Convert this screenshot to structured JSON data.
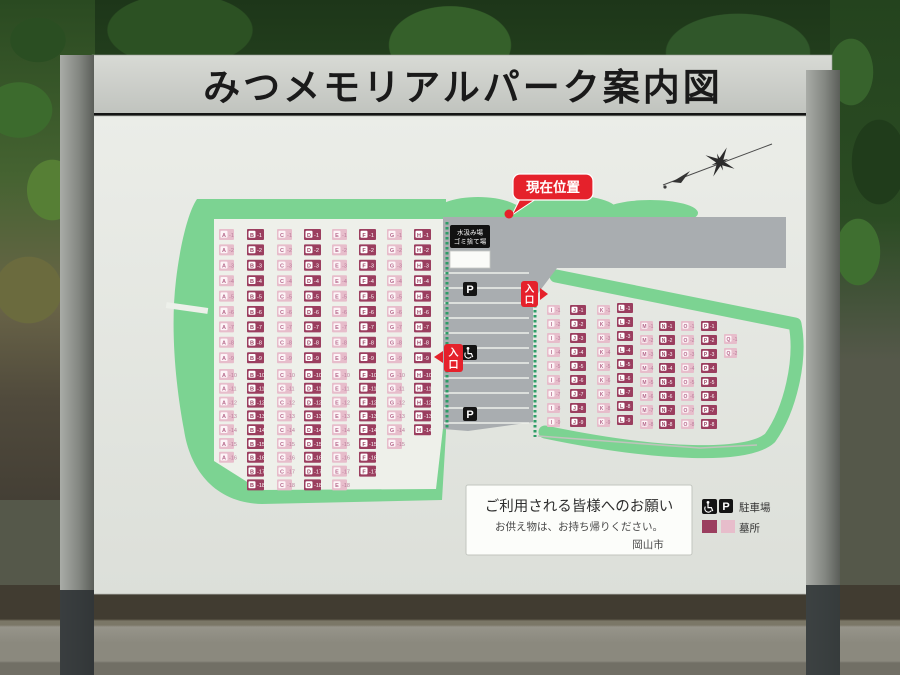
{
  "sign": {
    "title": "みつメモリアルパーク案内図"
  },
  "map": {
    "current_location": {
      "label": "現在位置"
    },
    "entrances": {
      "label": "入口",
      "char1": "入",
      "char2": "口"
    },
    "facility": {
      "line1": "水汲み場",
      "line2": "ゴミ捨て場"
    },
    "icons": {
      "parking": "P"
    },
    "plots": {
      "blocks": [
        {
          "name": "west",
          "cell": {
            "h": 11,
            "dark_w": 17,
            "pink_w": 15,
            "font": 5.5
          },
          "cols": [
            {
              "letter": "A",
              "shade": "pink",
              "x": 219,
              "segments": [
                {
                  "y": 229,
                  "pitch": 15.4,
                  "from": 1,
                  "to": 9
                },
                {
                  "y": 369,
                  "pitch": 13.8,
                  "from": 10,
                  "to": 16
                }
              ]
            },
            {
              "letter": "B",
              "shade": "dark",
              "x": 247,
              "segments": [
                {
                  "y": 229,
                  "pitch": 15.4,
                  "from": 1,
                  "to": 9
                },
                {
                  "y": 369,
                  "pitch": 13.8,
                  "from": 10,
                  "to": 18
                }
              ]
            },
            {
              "letter": "C",
              "shade": "pink",
              "x": 277,
              "segments": [
                {
                  "y": 229,
                  "pitch": 15.4,
                  "from": 1,
                  "to": 9
                },
                {
                  "y": 369,
                  "pitch": 13.8,
                  "from": 10,
                  "to": 18
                }
              ]
            },
            {
              "letter": "D",
              "shade": "dark",
              "x": 304,
              "segments": [
                {
                  "y": 229,
                  "pitch": 15.4,
                  "from": 1,
                  "to": 9
                },
                {
                  "y": 369,
                  "pitch": 13.8,
                  "from": 10,
                  "to": 18
                }
              ]
            },
            {
              "letter": "E",
              "shade": "pink",
              "x": 332,
              "segments": [
                {
                  "y": 229,
                  "pitch": 15.4,
                  "from": 1,
                  "to": 9
                },
                {
                  "y": 369,
                  "pitch": 13.8,
                  "from": 10,
                  "to": 18
                }
              ]
            },
            {
              "letter": "F",
              "shade": "dark",
              "x": 359,
              "segments": [
                {
                  "y": 229,
                  "pitch": 15.4,
                  "from": 1,
                  "to": 9
                },
                {
                  "y": 369,
                  "pitch": 13.8,
                  "from": 10,
                  "to": 17
                }
              ]
            },
            {
              "letter": "G",
              "shade": "pink",
              "x": 387,
              "segments": [
                {
                  "y": 229,
                  "pitch": 15.4,
                  "from": 1,
                  "to": 9
                },
                {
                  "y": 369,
                  "pitch": 13.8,
                  "from": 10,
                  "to": 15
                }
              ]
            },
            {
              "letter": "H",
              "shade": "dark",
              "x": 414,
              "segments": [
                {
                  "y": 229,
                  "pitch": 15.4,
                  "from": 1,
                  "to": 9
                },
                {
                  "y": 369,
                  "pitch": 13.8,
                  "from": 10,
                  "to": 14
                }
              ]
            }
          ]
        },
        {
          "name": "east",
          "cell": {
            "h": 10,
            "dark_w": 16,
            "pink_w": 13,
            "font": 5
          },
          "cols": [
            {
              "letter": "I",
              "shade": "pink",
              "x": 547,
              "segments": [
                {
                  "y": 305,
                  "pitch": 14,
                  "from": 1,
                  "to": 9
                }
              ]
            },
            {
              "letter": "J",
              "shade": "dark",
              "x": 570,
              "segments": [
                {
                  "y": 305,
                  "pitch": 14,
                  "from": 1,
                  "to": 9
                }
              ]
            },
            {
              "letter": "K",
              "shade": "pink",
              "x": 597,
              "segments": [
                {
                  "y": 305,
                  "pitch": 14,
                  "from": 1,
                  "to": 9
                }
              ]
            },
            {
              "letter": "L",
              "shade": "dark",
              "x": 617,
              "segments": [
                {
                  "y": 303,
                  "pitch": 14,
                  "from": 1,
                  "to": 9
                }
              ]
            },
            {
              "letter": "M",
              "shade": "pink",
              "x": 640,
              "segments": [
                {
                  "y": 321,
                  "pitch": 14,
                  "from": 1,
                  "to": 8
                }
              ]
            },
            {
              "letter": "N",
              "shade": "dark",
              "x": 659,
              "segments": [
                {
                  "y": 321,
                  "pitch": 14,
                  "from": 1,
                  "to": 8
                }
              ]
            },
            {
              "letter": "O",
              "shade": "pink",
              "x": 681,
              "segments": [
                {
                  "y": 321,
                  "pitch": 14,
                  "from": 1,
                  "to": 8
                }
              ]
            },
            {
              "letter": "P",
              "shade": "dark",
              "x": 701,
              "segments": [
                {
                  "y": 321,
                  "pitch": 14,
                  "from": 1,
                  "to": 8
                }
              ]
            },
            {
              "letter": "Q",
              "shade": "pink",
              "x": 724,
              "segments": [
                {
                  "y": 334,
                  "pitch": 14,
                  "from": 1,
                  "to": 2
                }
              ]
            }
          ]
        }
      ]
    }
  },
  "notice": {
    "heading": "ご利用される皆様へのお願い",
    "body": "お供え物は、お持ち帰りください。",
    "signature": "岡山市"
  },
  "legend": {
    "parking_label": "駐車場",
    "plots_label": "墓所"
  },
  "colors": {
    "plot_dark": "#9b3e5f",
    "plot_pink": "#e7bdcb",
    "map_green": "#7cd392",
    "road_gray": "#a9adb0",
    "hedge_green": "#2d9c66",
    "accent_red": "#e5212b",
    "board": "#e9ebe6"
  }
}
